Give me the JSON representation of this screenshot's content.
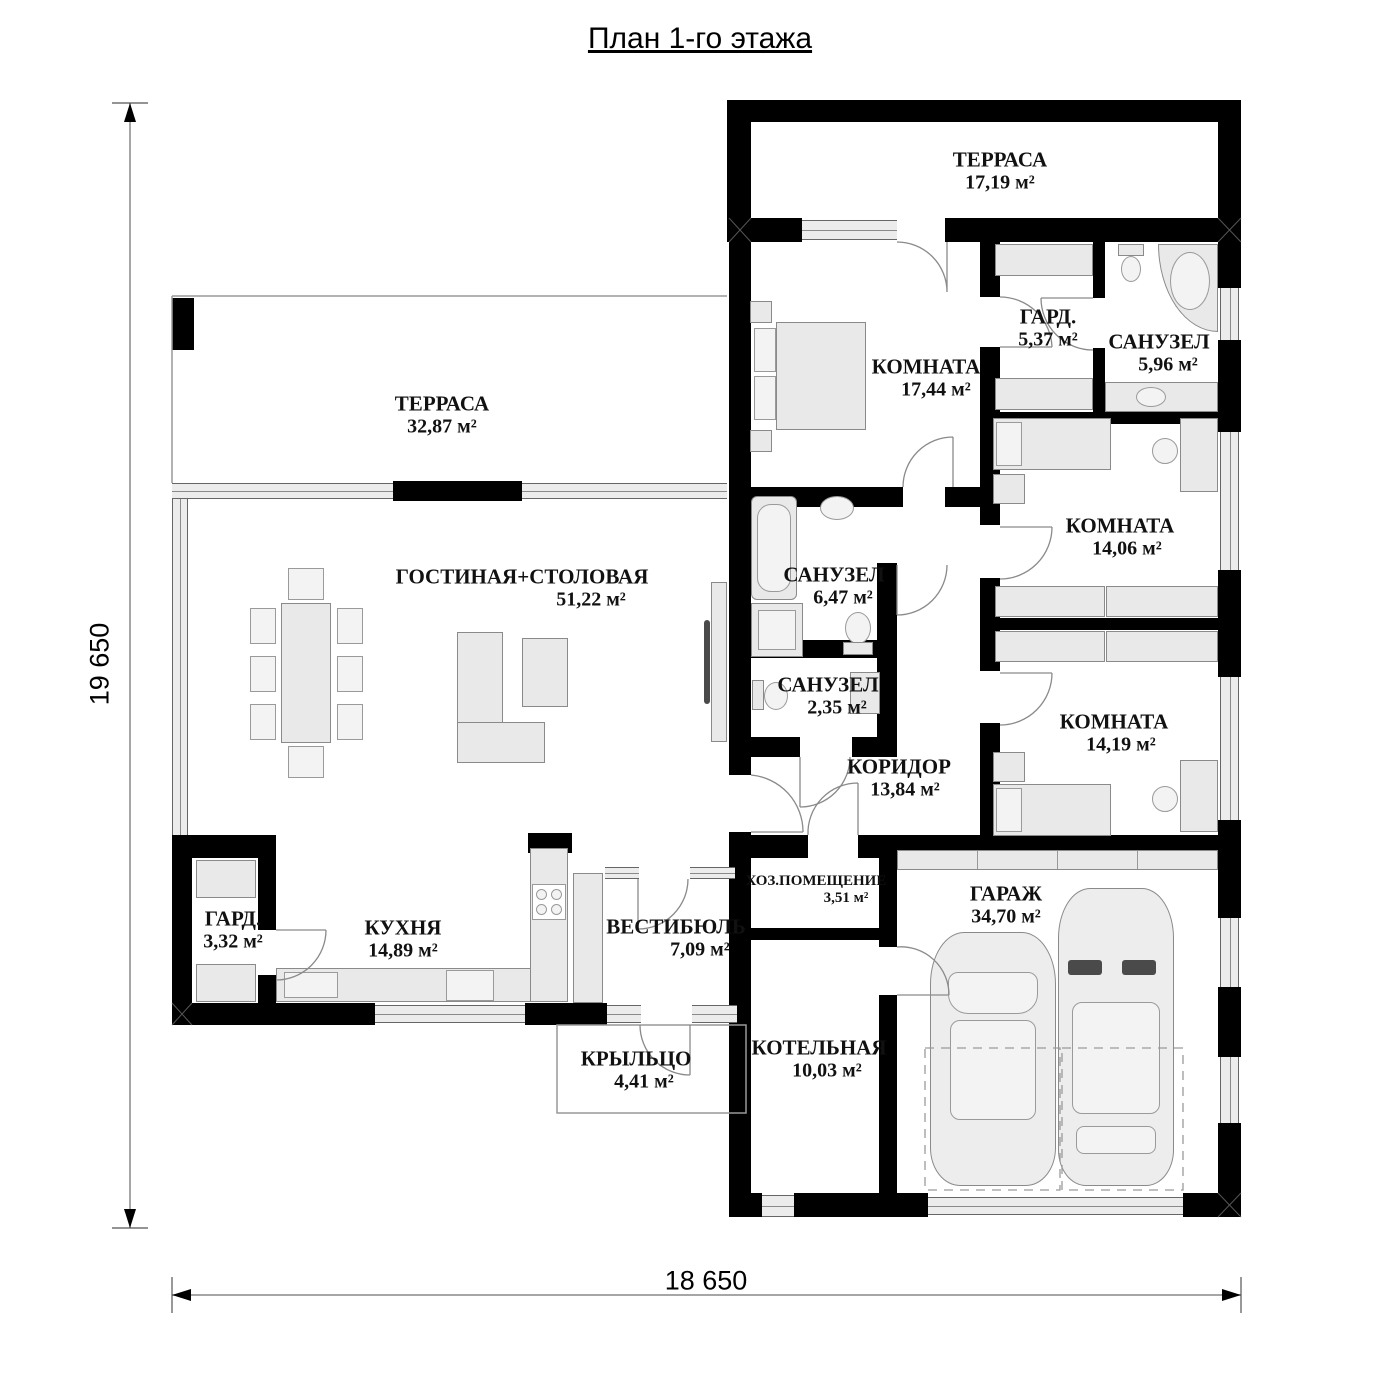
{
  "title": "План 1-го этажа",
  "dimensions": {
    "vertical": "19 650",
    "horizontal": "18 650"
  },
  "rooms": [
    {
      "name": "ТЕРРАСА",
      "area": "17,19 м²"
    },
    {
      "name": "ТЕРРАСА",
      "area": "32,87 м²"
    },
    {
      "name": "КОМНАТА",
      "area": "17,44 м²"
    },
    {
      "name": "ГАРД.",
      "area": "5,37 м²"
    },
    {
      "name": "САНУЗЕЛ",
      "area": "5,96 м²"
    },
    {
      "name": "КОМНАТА",
      "area": "14,06 м²"
    },
    {
      "name": "ГОСТИНАЯ+СТОЛОВАЯ",
      "area": "51,22 м²"
    },
    {
      "name": "САНУЗЕЛ",
      "area": "6,47 м²"
    },
    {
      "name": "САНУЗЕЛ",
      "area": "2,35 м²"
    },
    {
      "name": "КОМНАТА",
      "area": "14,19 м²"
    },
    {
      "name": "КОРИДОР",
      "area": "13,84 м²"
    },
    {
      "name": "ГАРД.",
      "area": "3,32 м²"
    },
    {
      "name": "КУХНЯ",
      "area": "14,89 м²"
    },
    {
      "name": "ВЕСТИБЮЛЬ",
      "area": "7,09 м²"
    },
    {
      "name": "ХОЗ.ПОМЕЩЕНИЕ",
      "area": "3,51 м²"
    },
    {
      "name": "ГАРАЖ",
      "area": "34,70 м²"
    },
    {
      "name": "КРЫЛЬЦО",
      "area": "4,41 м²"
    },
    {
      "name": "КОТЕЛЬНАЯ",
      "area": "10,03 м²"
    }
  ],
  "colors": {
    "wall": "#000000",
    "window_fill": "#ececec",
    "furniture_fill": "#e9e9e9",
    "furniture_stroke": "#8a8a8a",
    "line": "#777777",
    "background": "#ffffff",
    "text": "#000000"
  }
}
